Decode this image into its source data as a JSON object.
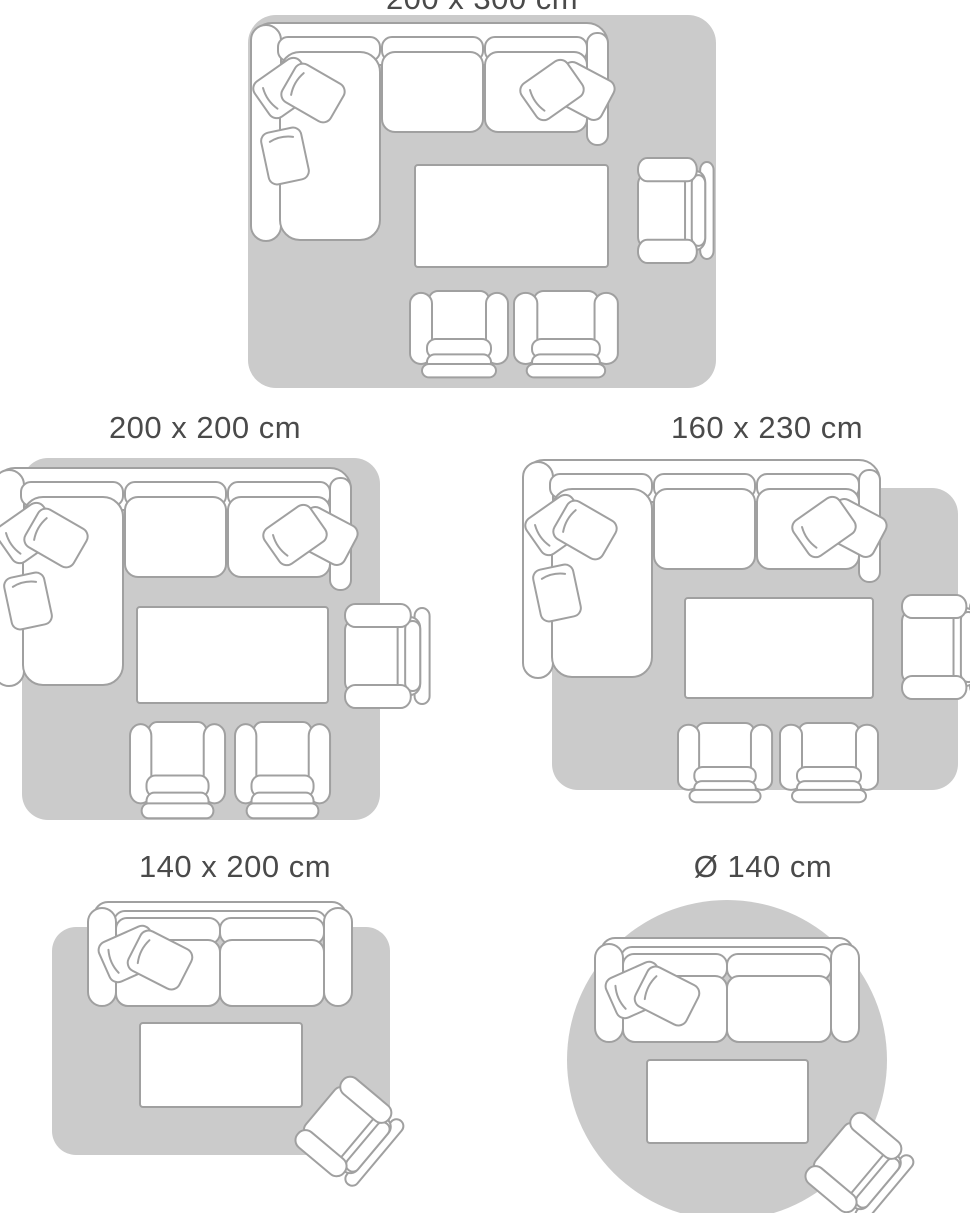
{
  "colors": {
    "background": "#ffffff",
    "rug": "#cbcbcb",
    "outline": "#a0a0a0",
    "furniture_fill": "#ffffff",
    "label_text": "#4a4a4a"
  },
  "size_guide": {
    "layouts": [
      {
        "label": "200 x 300 cm",
        "rug_shape": "rectangle",
        "furniture": [
          "corner-sofa",
          "coffee-table",
          "armchair",
          "ottoman",
          "ottoman"
        ]
      },
      {
        "label": "200 x 200 cm",
        "rug_shape": "rectangle",
        "furniture": [
          "corner-sofa",
          "coffee-table",
          "armchair",
          "ottoman",
          "ottoman"
        ]
      },
      {
        "label": "160 x 230 cm",
        "rug_shape": "rectangle",
        "furniture": [
          "corner-sofa",
          "coffee-table",
          "armchair",
          "ottoman",
          "ottoman"
        ]
      },
      {
        "label": "140 x 200 cm",
        "rug_shape": "rectangle",
        "furniture": [
          "two-seat-sofa",
          "coffee-table",
          "armchair"
        ]
      },
      {
        "label": "Ø 140 cm",
        "rug_shape": "circle",
        "furniture": [
          "two-seat-sofa",
          "coffee-table",
          "armchair"
        ]
      }
    ]
  }
}
